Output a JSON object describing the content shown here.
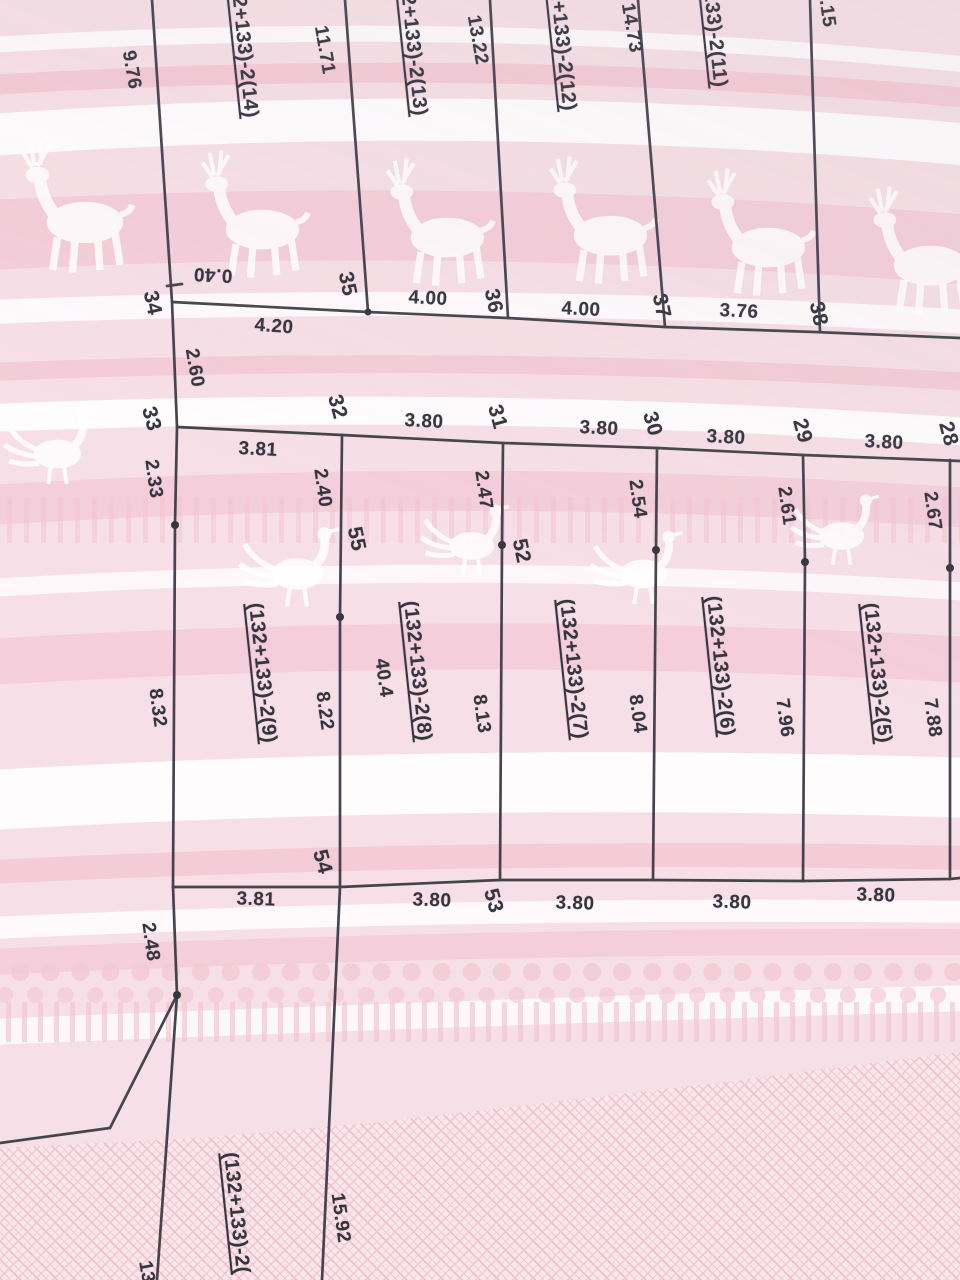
{
  "sheet": {
    "parcels": {
      "p14": "(132+133)-2(14)",
      "p13": "(132+133)-2(13)",
      "p12": "(132+133)-2(12)",
      "p11": "(132+133)-2(11)",
      "p9": "(132+133)-2(9)",
      "p8": "(132+133)-2(8)",
      "p8_area": "40.4",
      "p7": "(132+133)-2(7)",
      "p6": "(132+133)-2(6)",
      "p5": "(132+133)-2(5)",
      "p_bottom": "(132+133)-2("
    },
    "points": {
      "n28": "28",
      "n29": "29",
      "n30": "30",
      "n31": "31",
      "n32": "32",
      "n33": "33",
      "n34": "34",
      "n35": "35",
      "n36": "36",
      "n37": "37",
      "n38": "38",
      "n52": "52",
      "n53": "53",
      "n54": "54",
      "n55": "55"
    },
    "dims": {
      "d9_76": "9.76",
      "d11_71": "11.71",
      "d13_22": "13.22",
      "d14_73": "14.73",
      "d8_15": "8.15",
      "d0_40": "0.40",
      "d4_20": "4.20",
      "d4_00a": "4.00",
      "d4_00b": "4.00",
      "d3_76": "3.76",
      "d2_60": "2.60",
      "d2_33": "2.33",
      "d2_40": "2.40",
      "d2_47": "2.47",
      "d2_54": "2.54",
      "d2_61": "2.61",
      "d2_67": "2.67",
      "d3_81_top": "3.81",
      "d3_80_t1": "3.80",
      "d3_80_t2": "3.80",
      "d3_80_t3": "3.80",
      "d3_80_t4": "3.80",
      "d8_32": "8.32",
      "d8_22": "8.22",
      "d8_13": "8.13",
      "d8_04": "8.04",
      "d7_96": "7.96",
      "d7_88": "7.88",
      "d3_81_b": "3.81",
      "d3_80_b1": "3.80",
      "d3_80_b2": "3.80",
      "d3_80_b3": "3.80",
      "d3_80_b4": "3.80",
      "d2_48": "2.48",
      "d15_92": "15.92",
      "d13_cut": "13"
    },
    "ink_color": "#3c3c43",
    "paper_pink": "#f6dfe6"
  }
}
